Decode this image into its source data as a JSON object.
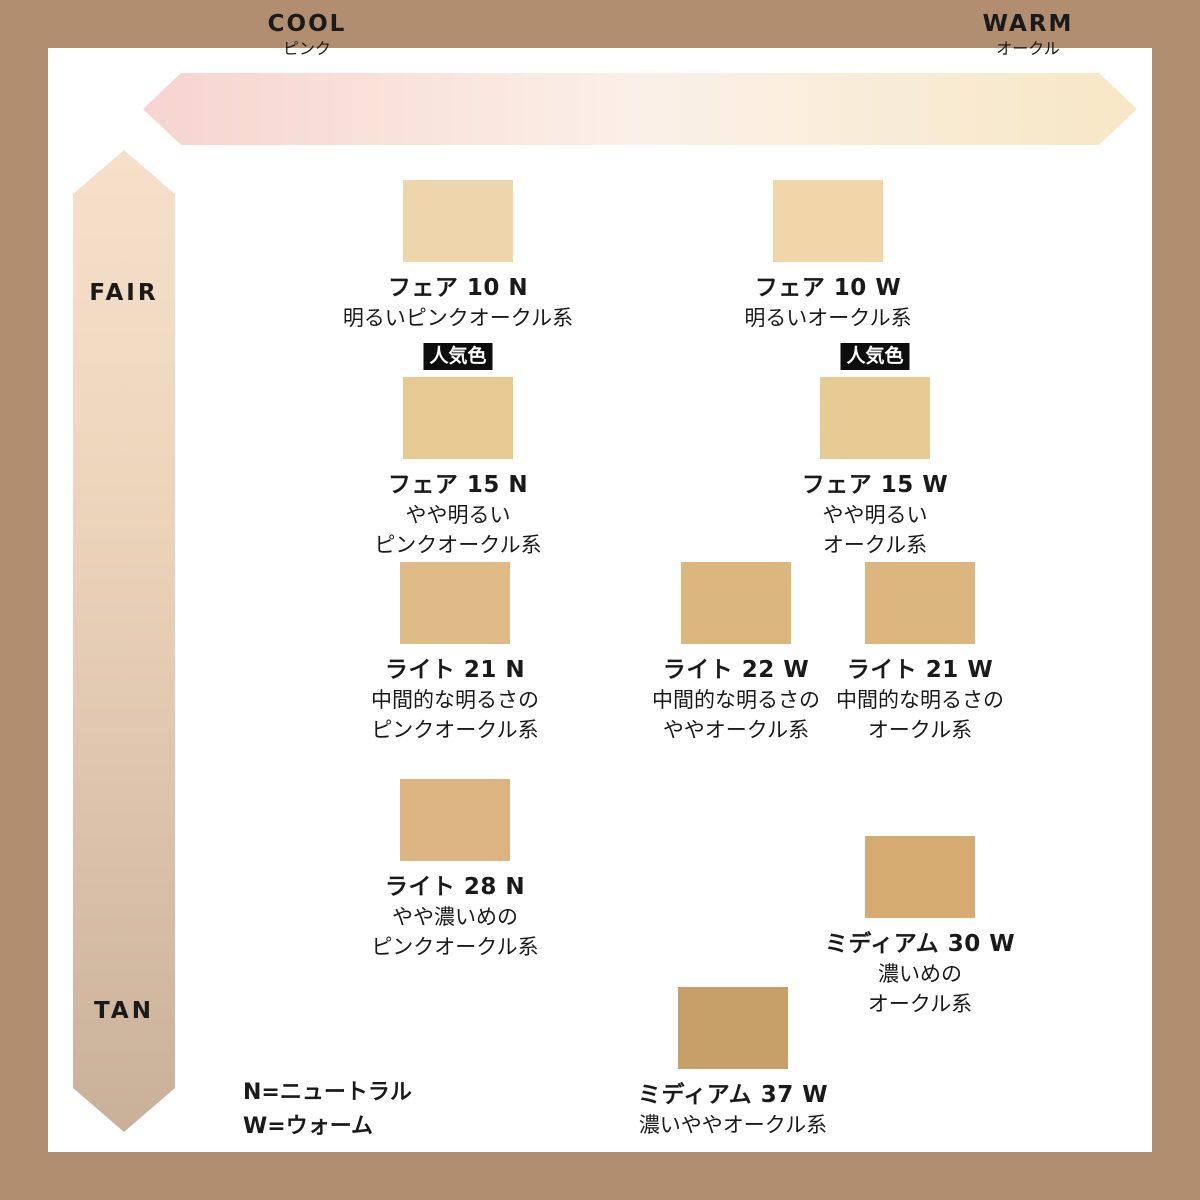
{
  "frame_color": "#b18e6f",
  "badge_label": "人気色",
  "legend": {
    "line1": "N=ニュートラル",
    "line2": "W=ウォーム"
  },
  "chart_data": {
    "type": "scatter",
    "title": "",
    "x_axis": {
      "meaning": "undertone cool to warm",
      "left": {
        "title": "COOL",
        "subtitle": "ピンク"
      },
      "right": {
        "title": "WARM",
        "subtitle": "オークル"
      },
      "gradient": [
        "#f7d4cf",
        "#f9e2d9",
        "#fbf0e9",
        "#f9ecd6",
        "#f8e7c5"
      ]
    },
    "y_axis": {
      "meaning": "depth fair to tan",
      "top": "FAIR",
      "bottom": "TAN",
      "gradient": [
        "#f6e0ca",
        "#eed6bd",
        "#ddc3ab",
        "#c9b099"
      ]
    },
    "points": [
      {
        "name": "フェア 10 N",
        "desc": [
          "明るいピンクオークル系"
        ],
        "color": "#eed5ab",
        "popular": false,
        "x": 458,
        "y": 180
      },
      {
        "name": "フェア 10 W",
        "desc": [
          "明るいオークル系"
        ],
        "color": "#f0d6a9",
        "popular": false,
        "x": 828,
        "y": 180
      },
      {
        "name": "フェア 15 N",
        "desc": [
          "やや明るい",
          "ピンクオークル系"
        ],
        "color": "#e7c992",
        "popular": true,
        "x": 458,
        "y": 377
      },
      {
        "name": "フェア 15 W",
        "desc": [
          "やや明るい",
          "オークル系"
        ],
        "color": "#e8ca93",
        "popular": true,
        "x": 875,
        "y": 377
      },
      {
        "name": "ライト 21 N",
        "desc": [
          "中間的な明るさの",
          "ピンクオークル系"
        ],
        "color": "#dfbc87",
        "popular": false,
        "x": 455,
        "y": 562
      },
      {
        "name": "ライト 22 W",
        "desc": [
          "中間的な明るさの",
          "ややオークル系"
        ],
        "color": "#dcb67f",
        "popular": false,
        "x": 736,
        "y": 562
      },
      {
        "name": "ライト 21 W",
        "desc": [
          "中間的な明るさの",
          "オークル系"
        ],
        "color": "#dbb67f",
        "popular": false,
        "x": 920,
        "y": 562
      },
      {
        "name": "ライト 28 N",
        "desc": [
          "やや濃いめの",
          "ピンクオークル系"
        ],
        "color": "#dcb482",
        "popular": false,
        "x": 455,
        "y": 779
      },
      {
        "name": "ミディアム 30 W",
        "desc": [
          "濃いめの",
          "オークル系"
        ],
        "color": "#d5ab71",
        "popular": false,
        "x": 920,
        "y": 836
      },
      {
        "name": "ミディアム 37 W",
        "desc": [
          "濃いややオークル系"
        ],
        "color": "#c79f69",
        "popular": false,
        "x": 733,
        "y": 987
      }
    ]
  }
}
